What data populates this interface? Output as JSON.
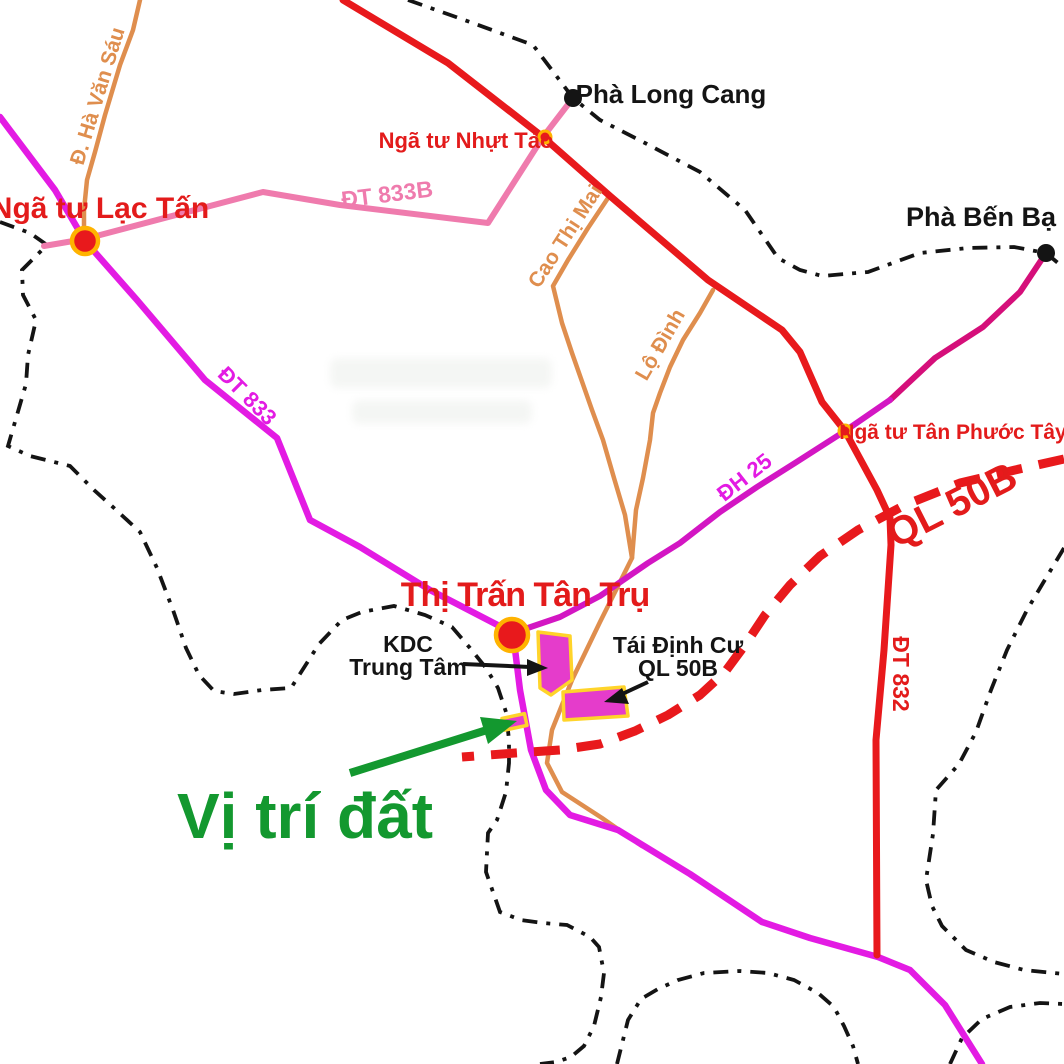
{
  "map": {
    "colors": {
      "road_red": "#E8191C",
      "road_magenta": "#E31BE3",
      "road_pink": "#EF7BAD",
      "road_orange": "#DF8E4E",
      "road_dh25_upper": "#D50F7A",
      "road_dh25_lower": "#D316C3",
      "boundary": "#141414",
      "site_green": "#13982F",
      "label_red": "#E31B1B",
      "label_black": "#141414",
      "plot_fill": "#E53CCB",
      "plot_stroke": "#FFD42A",
      "node_ring": "#FFB300"
    },
    "labels": {
      "ferry_long_cang": "Phà Long Cang",
      "ferry_ben_ba": "Phà Bến Bạ",
      "int_lac_tan": "Ngã tư Lạc Tấn",
      "int_nhut_tao": "Ngã tư Nhựt Tảo",
      "int_tan_phuoc_tay": "Ngã tư Tân Phước Tây",
      "town": "Thị Trấn Tân Trụ",
      "road_dt833": "ĐT 833",
      "road_dt833b": "ĐT 833B",
      "road_dt832": "ĐT 832",
      "road_dh25": "ĐH 25",
      "road_ql50b": "QL 50B",
      "road_ha_van_sau": "Đ. Hà Văn Sáu",
      "road_cao_thi_mai": "Cao Thị Mai",
      "road_lo_dinh": "Lộ Đình",
      "kdc_line1": "KDC",
      "kdc_line2": "Trung Tâm",
      "tdc_line1": "Tái Định Cư",
      "tdc_line2": "QL 50B",
      "site": "Vị trí đất"
    }
  }
}
